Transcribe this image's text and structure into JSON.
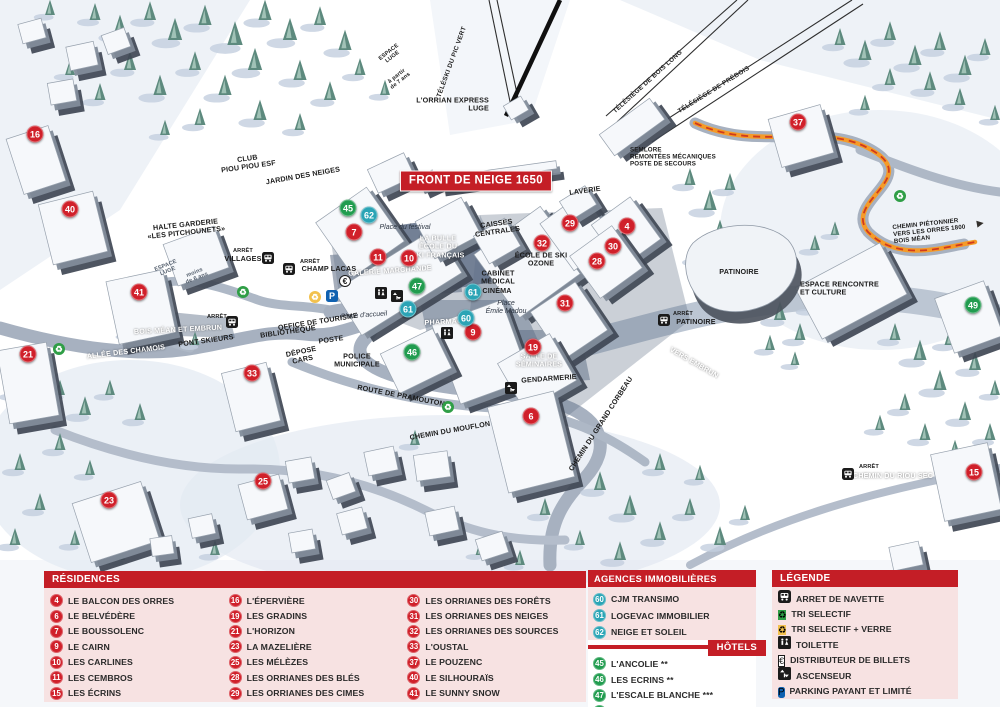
{
  "map": {
    "badge": "FRONT DE NEIGE 1650",
    "markers": [
      {
        "n": "4",
        "k": "red",
        "x": 627,
        "y": 226
      },
      {
        "n": "6",
        "k": "red",
        "x": 531,
        "y": 416
      },
      {
        "n": "7",
        "k": "red",
        "x": 354,
        "y": 232
      },
      {
        "n": "9",
        "k": "red",
        "x": 473,
        "y": 332
      },
      {
        "n": "10",
        "k": "red",
        "x": 409,
        "y": 258
      },
      {
        "n": "11",
        "k": "red",
        "x": 378,
        "y": 257
      },
      {
        "n": "15",
        "k": "red",
        "x": 974,
        "y": 472
      },
      {
        "n": "16",
        "k": "red",
        "x": 35,
        "y": 134
      },
      {
        "n": "19",
        "k": "red",
        "x": 533,
        "y": 347
      },
      {
        "n": "21",
        "k": "red",
        "x": 28,
        "y": 354
      },
      {
        "n": "23",
        "k": "red",
        "x": 109,
        "y": 500
      },
      {
        "n": "25",
        "k": "red",
        "x": 263,
        "y": 481
      },
      {
        "n": "28",
        "k": "red",
        "x": 597,
        "y": 261
      },
      {
        "n": "29",
        "k": "red",
        "x": 570,
        "y": 223
      },
      {
        "n": "30",
        "k": "red",
        "x": 613,
        "y": 246
      },
      {
        "n": "31",
        "k": "red",
        "x": 565,
        "y": 303
      },
      {
        "n": "32",
        "k": "red",
        "x": 542,
        "y": 243
      },
      {
        "n": "33",
        "k": "red",
        "x": 252,
        "y": 373
      },
      {
        "n": "37",
        "k": "red",
        "x": 798,
        "y": 122
      },
      {
        "n": "40",
        "k": "red",
        "x": 70,
        "y": 209
      },
      {
        "n": "41",
        "k": "red",
        "x": 139,
        "y": 292
      },
      {
        "n": "45",
        "k": "green",
        "x": 348,
        "y": 208
      },
      {
        "n": "46",
        "k": "green",
        "x": 412,
        "y": 352
      },
      {
        "n": "47",
        "k": "green",
        "x": 417,
        "y": 286
      },
      {
        "n": "49",
        "k": "green",
        "x": 973,
        "y": 305
      },
      {
        "n": "60",
        "k": "teal",
        "x": 466,
        "y": 318
      },
      {
        "n": "61",
        "k": "teal",
        "x": 473,
        "y": 292
      },
      {
        "n": "61",
        "k": "teal",
        "x": 408,
        "y": 309
      },
      {
        "n": "62",
        "k": "teal",
        "x": 369,
        "y": 215
      }
    ],
    "labels": [
      {
        "t": "CLUB\nPIOU PIOU ESF",
        "x": 248,
        "y": 163,
        "c": "",
        "r": -8
      },
      {
        "t": "JARDIN DES NEIGES",
        "x": 303,
        "y": 176,
        "c": "",
        "r": -10
      },
      {
        "t": "ESPACE\nLUGE",
        "x": 391,
        "y": 55,
        "c": "tiny",
        "r": -38
      },
      {
        "t": "à partir\nde 7 ans",
        "x": 399,
        "y": 79,
        "c": "tiny",
        "r": -38
      },
      {
        "t": "L'ORRIAN EXPRESS\nLUGE",
        "x": 489,
        "y": 105,
        "c": "rightal",
        "r": 0
      },
      {
        "t": "TÉLÉSKI DU PIC VERT",
        "x": 452,
        "y": 62,
        "c": "lift",
        "r": -70
      },
      {
        "t": "TÉLÉSIÈGE DE BOIS LONG",
        "x": 648,
        "y": 82,
        "c": "lift",
        "r": -42
      },
      {
        "t": "TÉLÉSIÈGE DE PRÉBOIS",
        "x": 714,
        "y": 90,
        "c": "lift",
        "r": -32
      },
      {
        "t": "SEMLORE\nREMONTÉES MÉCANIQUES\nPOSTE DE SECOURS",
        "x": 630,
        "y": 157,
        "c": "leftal tiny2",
        "r": 0
      },
      {
        "t": "HALTE GARDERIE\n«LES PITCHOUNETS»",
        "x": 186,
        "y": 229,
        "c": "",
        "r": -6
      },
      {
        "t": "ESPACE\nLUGE",
        "x": 167,
        "y": 269,
        "c": "gray tiny",
        "r": -22
      },
      {
        "t": "moins\nde 6 ans",
        "x": 196,
        "y": 276,
        "c": "gray tiny",
        "r": -22
      },
      {
        "t": "ARRÊT",
        "x": 243,
        "y": 251,
        "c": "tiny",
        "r": 0
      },
      {
        "t": "VILLAGES",
        "x": 243,
        "y": 259,
        "c": "",
        "r": 0
      },
      {
        "t": "ARRÊT",
        "x": 310,
        "y": 262,
        "c": "tiny",
        "r": 0
      },
      {
        "t": "CHAMP LACAS",
        "x": 329,
        "y": 269,
        "c": "",
        "r": 0
      },
      {
        "t": "Place du festival",
        "x": 405,
        "y": 228,
        "c": "italic",
        "r": 0
      },
      {
        "t": "LA BULLE\nÉCOLE DU\nSKI FRANÇAIS",
        "x": 438,
        "y": 247,
        "c": "white",
        "r": 0
      },
      {
        "t": "GALERIE MARCHANDE",
        "x": 390,
        "y": 271,
        "c": "white",
        "r": -4
      },
      {
        "t": "CAISSES\nCENTRALES",
        "x": 497,
        "y": 228,
        "c": "",
        "r": -8
      },
      {
        "t": "LAVERIE",
        "x": 585,
        "y": 191,
        "c": "",
        "r": -8
      },
      {
        "t": "ÉCOLE DE SKI\nOZONE",
        "x": 541,
        "y": 260,
        "c": "",
        "r": 0
      },
      {
        "t": "CABINET\nMÉDICAL",
        "x": 498,
        "y": 278,
        "c": "",
        "r": 0
      },
      {
        "t": "CINÉMA",
        "x": 497,
        "y": 291,
        "c": "",
        "r": 0
      },
      {
        "t": "Place\nÉmile Madou",
        "x": 506,
        "y": 308,
        "c": "italic",
        "r": 0
      },
      {
        "t": "PHARMACIE",
        "x": 447,
        "y": 322,
        "c": "white",
        "r": -3
      },
      {
        "t": "PATINOIRE",
        "x": 739,
        "y": 272,
        "c": "",
        "r": 0
      },
      {
        "t": "ESPACE RENCONTRE\nET CULTURE",
        "x": 800,
        "y": 289,
        "c": "leftal",
        "r": 0
      },
      {
        "t": "ARRÊT",
        "x": 683,
        "y": 314,
        "c": "tiny",
        "r": 0
      },
      {
        "t": "PATINOIRE",
        "x": 696,
        "y": 322,
        "c": "",
        "r": 0
      },
      {
        "t": "VERS EMBRUN",
        "x": 694,
        "y": 363,
        "c": "white",
        "r": 30
      },
      {
        "t": "CHEMIN DU GRAND CORBEAU",
        "x": 601,
        "y": 424,
        "c": "",
        "r": -57
      },
      {
        "t": "CHEMIN DU MOUFLON",
        "x": 450,
        "y": 431,
        "c": "",
        "r": -10
      },
      {
        "t": "ROUTE DE PRAMOUTON",
        "x": 401,
        "y": 396,
        "c": "",
        "r": 11
      },
      {
        "t": "ALLÉE DES CHAMOIS",
        "x": 126,
        "y": 352,
        "c": "white",
        "r": -7
      },
      {
        "t": "PONT SKIEURS",
        "x": 206,
        "y": 341,
        "c": "",
        "r": -8
      },
      {
        "t": "ARRÊT",
        "x": 217,
        "y": 317,
        "c": "tiny",
        "r": 0
      },
      {
        "t": "BOIS MÉAN ET EMBRUN",
        "x": 178,
        "y": 330,
        "c": "white",
        "r": -3
      },
      {
        "t": "BIBLIOTHÈQUE",
        "x": 288,
        "y": 332,
        "c": "",
        "r": -8
      },
      {
        "t": "POSTE",
        "x": 331,
        "y": 340,
        "c": "",
        "r": -8
      },
      {
        "t": "OFFICE DE TOURISME",
        "x": 318,
        "y": 322,
        "c": "",
        "r": -9
      },
      {
        "t": "Place d'accueil",
        "x": 364,
        "y": 316,
        "c": "italic",
        "r": -4
      },
      {
        "t": "DÉPOSE\nCARS",
        "x": 302,
        "y": 356,
        "c": "",
        "r": -12
      },
      {
        "t": "POLICE\nMUNICIPALE",
        "x": 357,
        "y": 361,
        "c": "",
        "r": 0
      },
      {
        "t": "SALLE DE\nSÉMINAIRES",
        "x": 539,
        "y": 361,
        "c": "white",
        "r": 0
      },
      {
        "t": "GENDARMERIE",
        "x": 549,
        "y": 379,
        "c": "",
        "r": -4
      },
      {
        "t": "ARRÊT",
        "x": 869,
        "y": 467,
        "c": "tiny",
        "r": 0
      },
      {
        "t": "CHEMIN DU RIOU SEC",
        "x": 893,
        "y": 476,
        "c": "white",
        "r": 0
      },
      {
        "t": "CHEMIN PIÉTONNIER\nVERS LES ORRES 1800\nBOIS MÉAN",
        "x": 893,
        "y": 231,
        "c": "leftal tiny2",
        "r": -6
      }
    ],
    "icons": [
      {
        "k": "bus",
        "x": 268,
        "y": 258
      },
      {
        "k": "bus",
        "x": 289,
        "y": 269
      },
      {
        "k": "bus",
        "x": 232,
        "y": 322
      },
      {
        "k": "bus",
        "x": 664,
        "y": 320
      },
      {
        "k": "bus",
        "x": 848,
        "y": 474
      },
      {
        "k": "recycle-green",
        "x": 243,
        "y": 292
      },
      {
        "k": "recycle-green",
        "x": 59,
        "y": 349
      },
      {
        "k": "recycle-green",
        "x": 448,
        "y": 407
      },
      {
        "k": "recycle-green",
        "x": 900,
        "y": 196
      },
      {
        "k": "recycle-yellow",
        "x": 315,
        "y": 297
      },
      {
        "k": "parking",
        "x": 332,
        "y": 296
      },
      {
        "k": "euro",
        "x": 345,
        "y": 281
      },
      {
        "k": "toilet",
        "x": 381,
        "y": 293
      },
      {
        "k": "toilet",
        "x": 447,
        "y": 333
      },
      {
        "k": "elevator",
        "x": 397,
        "y": 296
      },
      {
        "k": "elevator",
        "x": 511,
        "y": 388
      },
      {
        "k": "arrow-white",
        "x": 716,
        "y": 382,
        "r": 35
      },
      {
        "k": "arrow-dark",
        "x": 980,
        "y": 222,
        "r": -10
      }
    ]
  },
  "panels": {
    "residences": {
      "title": "RÉSIDENCES",
      "columns": [
        [
          {
            "n": "4",
            "label": "LE BALCON DES ORRES"
          },
          {
            "n": "6",
            "label": "LE BELVÉDÈRE"
          },
          {
            "n": "7",
            "label": "LE BOUSSOLENC"
          },
          {
            "n": "9",
            "label": "LE CAIRN"
          },
          {
            "n": "10",
            "label": "LES CARLINES"
          },
          {
            "n": "11",
            "label": "LES CEMBROS"
          },
          {
            "n": "15",
            "label": "LES ÉCRINS"
          }
        ],
        [
          {
            "n": "16",
            "label": "L'ÉPERVIÈRE"
          },
          {
            "n": "19",
            "label": "LES GRADINS"
          },
          {
            "n": "21",
            "label": "L'HORIZON"
          },
          {
            "n": "23",
            "label": "LA MAZELIÈRE"
          },
          {
            "n": "25",
            "label": "LES MÉLÈZES"
          },
          {
            "n": "28",
            "label": "LES ORRIANES DES BLÉS"
          },
          {
            "n": "29",
            "label": "LES ORRIANES DES CIMES"
          }
        ],
        [
          {
            "n": "30",
            "label": "LES ORRIANES DES FORÊTS"
          },
          {
            "n": "31",
            "label": "LES ORRIANES DES NEIGES"
          },
          {
            "n": "32",
            "label": "LES ORRIANES DES SOURCES"
          },
          {
            "n": "33",
            "label": "L'OUSTAL"
          },
          {
            "n": "37",
            "label": "LE POUZENC"
          },
          {
            "n": "40",
            "label": "LE SILHOURAÏS"
          },
          {
            "n": "41",
            "label": "LE SUNNY SNOW"
          }
        ]
      ]
    },
    "agences": {
      "title": "AGENCES IMMOBILIÈRES",
      "items": [
        {
          "n": "60",
          "label": "CJM TRANSIMO"
        },
        {
          "n": "61",
          "label": "LOGEVAC IMMOBILIER"
        },
        {
          "n": "62",
          "label": "NEIGE ET SOLEIL"
        }
      ]
    },
    "hotels": {
      "title": "HÔTELS",
      "items": [
        {
          "n": "45",
          "label": "L'ANCOLIE **"
        },
        {
          "n": "46",
          "label": "LES ECRINS **"
        },
        {
          "n": "47",
          "label": "L'ESCALE BLANCHE ***"
        },
        {
          "n": "49",
          "label": "LES TRAPPEURS **"
        }
      ]
    },
    "legende": {
      "title": "LÉGENDE",
      "items": [
        {
          "icon": "bus",
          "label": "ARRET DE NAVETTE"
        },
        {
          "icon": "recycle-green",
          "label": "TRI SELECTIF"
        },
        {
          "icon": "recycle-yellow",
          "label": "TRI SELECTIF + VERRE"
        },
        {
          "icon": "toilet",
          "label": "TOILETTE"
        },
        {
          "icon": "euro",
          "label": "DISTRIBUTEUR DE BILLETS"
        },
        {
          "icon": "elevator",
          "label": "ASCENSEUR"
        },
        {
          "icon": "parking",
          "label": "PARKING PAYANT ET LIMITÉ"
        }
      ]
    }
  },
  "colors": {
    "header_red": "#c41e26",
    "marker_red": "#d0202a",
    "marker_green": "#219c4f",
    "marker_teal": "#2ba4b5",
    "panel_pink": "#f7e2e2",
    "path_orange": "#f59b28",
    "parking_blue": "#1061b0"
  }
}
